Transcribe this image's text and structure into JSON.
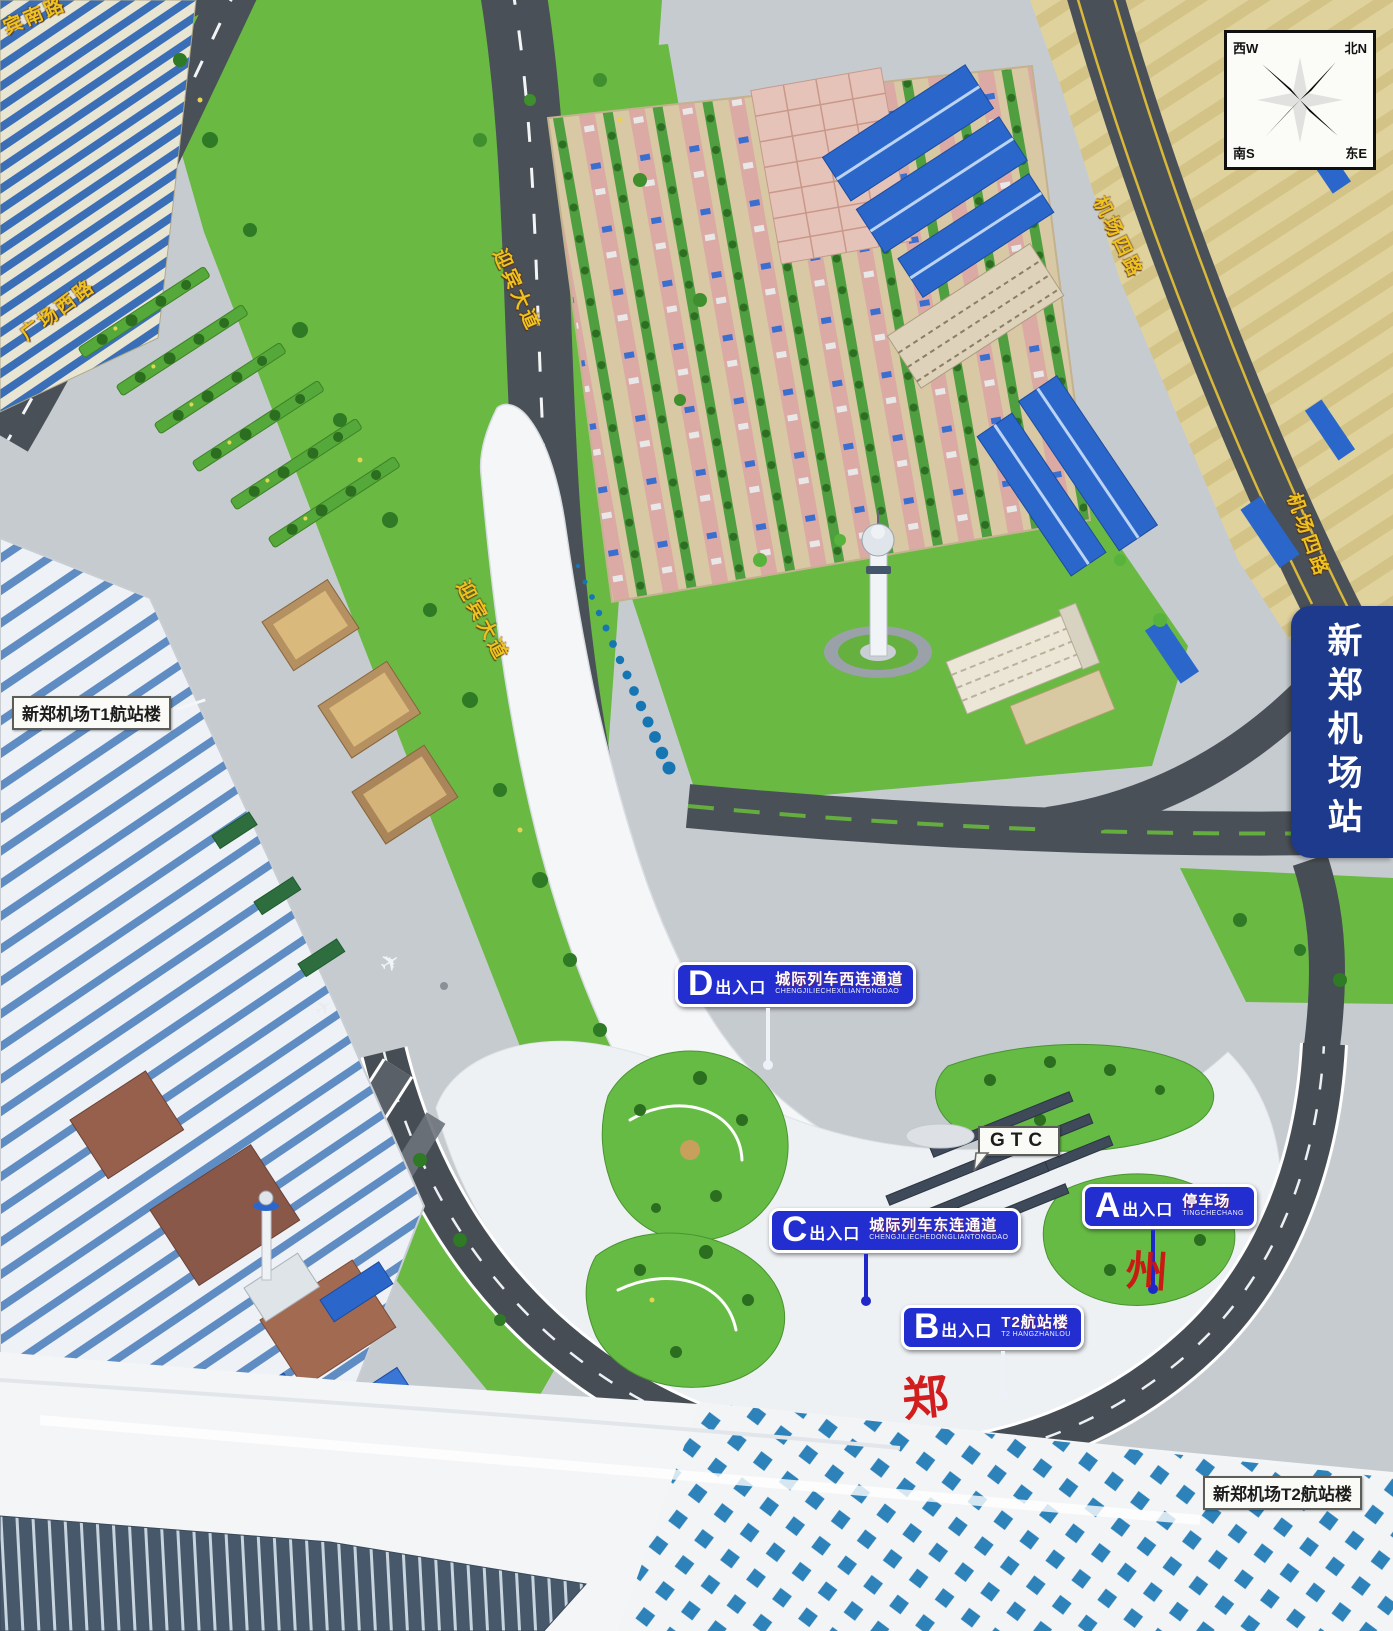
{
  "title": "新郑机场站",
  "compass": {
    "nw": "西W",
    "ne": "北N",
    "sw": "南S",
    "se": "东E"
  },
  "station_banner": "新郑机场站",
  "roads": [
    {
      "name": "宾南路"
    },
    {
      "name": "广场西路"
    },
    {
      "name": "迎宾大道"
    },
    {
      "name": "迎宾大道"
    },
    {
      "name": "机场四路"
    },
    {
      "name": "机场四路"
    }
  ],
  "landmarks": {
    "t1_label": "新郑机场T1航站楼",
    "t2_label": "新郑机场T2航站楼",
    "gtc_label": "GTC"
  },
  "entrances": [
    {
      "letter": "D",
      "suffix": "出入口",
      "name": "城际列车西连通道",
      "pinyin": "CHENGJILIECHEXILIANTONGDAO"
    },
    {
      "letter": "C",
      "suffix": "出入口",
      "name": "城际列车东连通道",
      "pinyin": "CHENGJILIECHEDONGLIANTONGDAO"
    },
    {
      "letter": "B",
      "suffix": "出入口",
      "name": "T2航站楼",
      "pinyin": "T2 HANGZHANLOU"
    },
    {
      "letter": "A",
      "suffix": "出入口",
      "name": "停车场",
      "pinyin": "TINGCHECHANG"
    }
  ],
  "red_marks": [
    "郑",
    "州"
  ],
  "colors": {
    "entrance_blue": "#232ed1",
    "banner_blue": "#1d3a8c",
    "road_label_gold": "#eec31e",
    "red_mark": "#d01212",
    "road_gray": "#4a5057",
    "grass_green": "#69b943",
    "farmland_tan": "#e0d29c",
    "roof_checker_blue": "#2e82ba"
  }
}
